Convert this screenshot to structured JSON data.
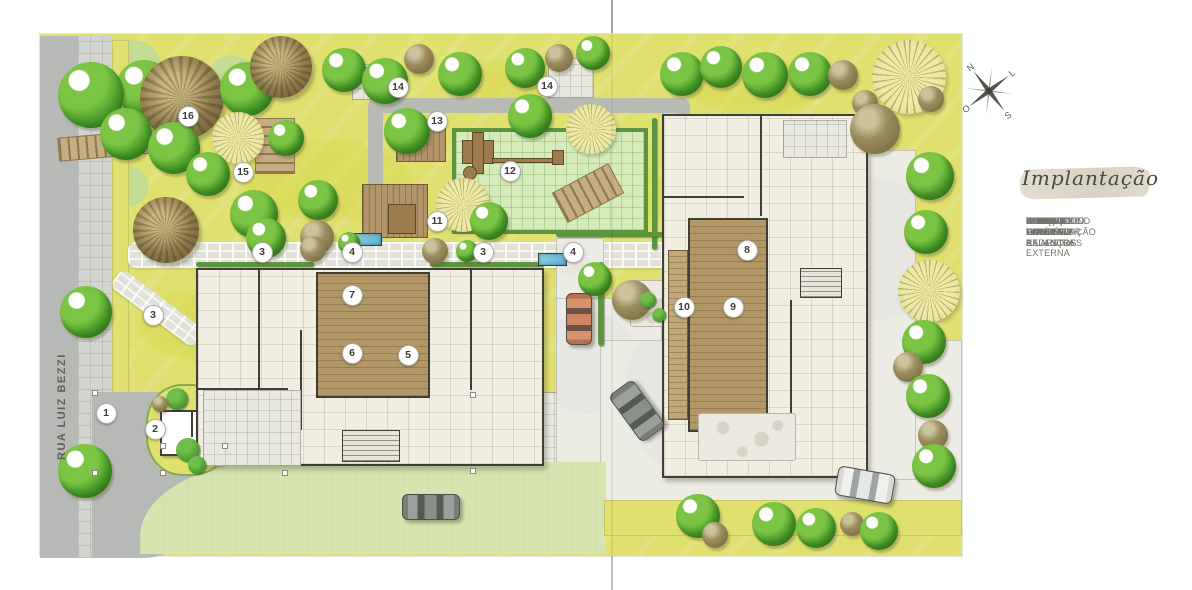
{
  "legend": {
    "title": "Implantação",
    "items": [
      {
        "num": "1",
        "label": "GUARITA"
      },
      {
        "num": "2",
        "label": "PORTE-COCHÉRE"
      },
      {
        "num": "3",
        "label": "CAMINHO DE PEDESTRES"
      },
      {
        "num": "4",
        "label": "FONTE"
      },
      {
        "num": "5",
        "label": "HALL TORRE A"
      },
      {
        "num": "6",
        "label": "ESPAÇO GOURMET"
      },
      {
        "num": "7",
        "label": "TERRAÇO GOURMET"
      },
      {
        "num": "8",
        "label": "HALL TORRE B"
      },
      {
        "num": "9",
        "label": "FITNESS"
      },
      {
        "num": "10",
        "label": "TERRAÇO FITNESS"
      },
      {
        "num": "11",
        "label": "PERGOLADO COM ESTAR E LAREIRA EXTERNA"
      },
      {
        "num": "12",
        "label": "PLAYGROUND EXTERNO"
      },
      {
        "num": "13",
        "label": "ESPAÇO FAMÍLIA"
      },
      {
        "num": "14",
        "label": "ESTAR EXTERNO"
      },
      {
        "num": "15",
        "label": "RECANTO DOS BALANÇOS"
      },
      {
        "num": "16",
        "label": "BOSQUE DE PRESERVAÇÃO"
      }
    ]
  },
  "plan": {
    "street_name": "RUA LUIZ BEZZI",
    "compass": {
      "north": "N",
      "east": "L",
      "south": "S",
      "west": "O"
    },
    "markers": [
      {
        "n": "16",
        "x": 188,
        "y": 116
      },
      {
        "n": "15",
        "x": 243,
        "y": 172
      },
      {
        "n": "14",
        "x": 398,
        "y": 87
      },
      {
        "n": "13",
        "x": 437,
        "y": 121
      },
      {
        "n": "14",
        "x": 547,
        "y": 86
      },
      {
        "n": "12",
        "x": 510,
        "y": 171
      },
      {
        "n": "11",
        "x": 437,
        "y": 221
      },
      {
        "n": "3",
        "x": 262,
        "y": 252
      },
      {
        "n": "4",
        "x": 352,
        "y": 252
      },
      {
        "n": "3",
        "x": 483,
        "y": 252
      },
      {
        "n": "4",
        "x": 573,
        "y": 252
      },
      {
        "n": "3",
        "x": 153,
        "y": 315
      },
      {
        "n": "7",
        "x": 352,
        "y": 295
      },
      {
        "n": "6",
        "x": 352,
        "y": 353
      },
      {
        "n": "5",
        "x": 408,
        "y": 355
      },
      {
        "n": "8",
        "x": 747,
        "y": 250
      },
      {
        "n": "10",
        "x": 684,
        "y": 307
      },
      {
        "n": "9",
        "x": 733,
        "y": 307
      },
      {
        "n": "1",
        "x": 106,
        "y": 413
      },
      {
        "n": "2",
        "x": 155,
        "y": 429
      }
    ]
  },
  "palette": {
    "lawn": "#dfe06e",
    "lawn_deep": "#d8da52",
    "lawn_light": "#d6e4b0",
    "playground": "#d5ecba",
    "street": "#b6b9b5",
    "sidewalk": "#d3d5d1",
    "cobble": "#e2e1d8",
    "court": "#ecebe4",
    "cream": "#f3eee2",
    "wall": "#3f3e37",
    "wood": "#b29867",
    "wood_light": "#c0a878",
    "hedge": "#5d9440",
    "water": "#5fb0cc",
    "marker_bg": "#ffffff",
    "text_gray": "#75746e",
    "title_ink": "#4a4843"
  }
}
